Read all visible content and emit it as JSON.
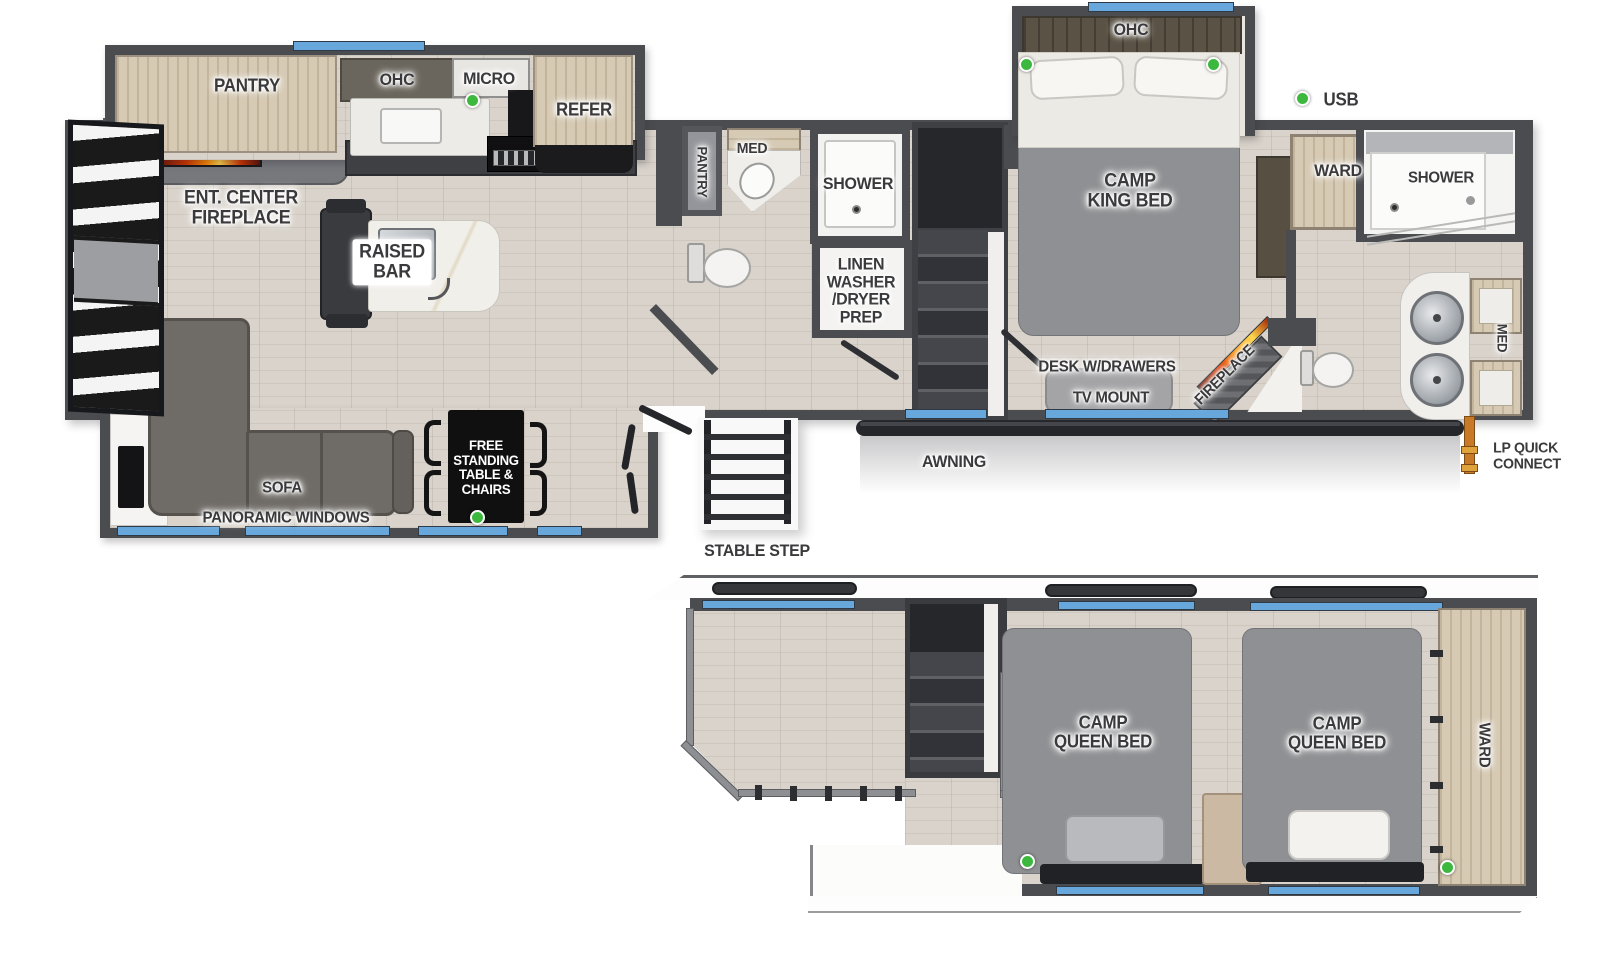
{
  "colors": {
    "wall": "#4b4c50",
    "wall_light": "#77787c",
    "floor_wood": "#d9d3cb",
    "cabinet_wood": "#d6cab4",
    "window_blue": "#68a7dc",
    "bed_gray": "#8f9093",
    "sofa_gray": "#6f6b66",
    "usb_green": "#3db83f",
    "lp_orange": "#c97a28",
    "tv_blue": "#2b57c8",
    "label_dark": "#3a3a3c"
  },
  "labels": {
    "pantry_kitchen": "PANTRY",
    "ohc_kitchen": "OHC",
    "micro": "MICRO",
    "refer": "REFER",
    "ent_center_fireplace": "ENT. CENTER\nFIREPLACE",
    "raised_bar": "RAISED\nBAR",
    "pantry_bath": "PANTRY",
    "med_bath": "MED",
    "shower_mid": "SHOWER",
    "linen_washer_dryer": "LINEN\nWASHER\n/DRYER\nPREP",
    "ohc_king": "OHC",
    "camp_king_bed": "CAMP\nKING BED",
    "usb_legend": "USB",
    "ward_bedroom": "WARD",
    "shower_rear": "SHOWER",
    "med_rear": "MED",
    "desk_w_drawers": "DESK W/DRAWERS",
    "tv_mount": "TV MOUNT",
    "fireplace_rear": "FIREPLACE",
    "sofa": "SOFA",
    "panoramic_windows": "PANORAMIC WINDOWS",
    "free_standing_table": "FREE\nSTANDING\nTABLE &\nCHAIRS",
    "awning": "AWNING",
    "stable_step": "STABLE STEP",
    "lp_quick_connect": "LP QUICK\nCONNECT",
    "camp_queen_bed_1": "CAMP\nQUEEN BED",
    "camp_queen_bed_2": "CAMP\nQUEEN BED",
    "ward_loft": "WARD"
  }
}
